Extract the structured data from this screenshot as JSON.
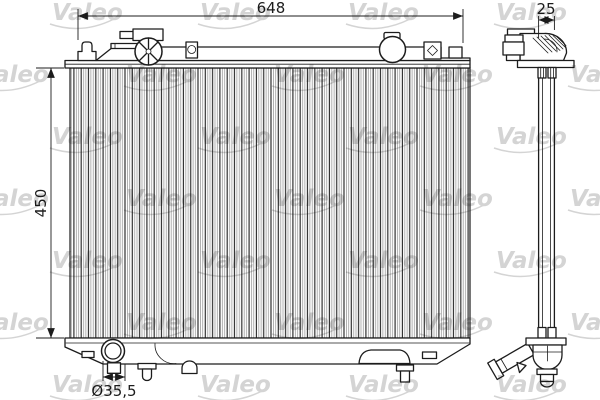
{
  "watermark": {
    "text": "Valeo",
    "color": "#c9c9c9"
  },
  "dimensions": {
    "overall_width": "648",
    "core_height": "450",
    "depth": "25",
    "hose_diameter": "Ø35,5"
  },
  "drawing": {
    "line_color": "#1c1c1c",
    "background": "#ffffff"
  }
}
